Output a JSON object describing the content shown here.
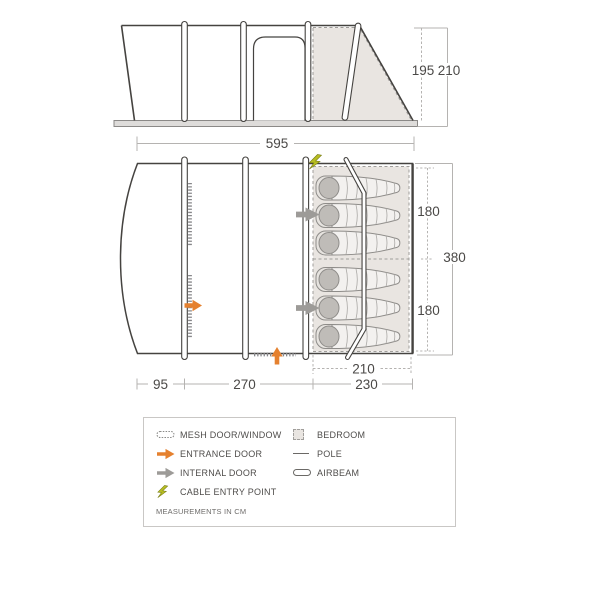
{
  "elevation": {
    "height_inner_cm": "195",
    "height_peak_cm": "210",
    "width_cm": "595"
  },
  "plan": {
    "bedroom_depth_upper_cm": "180",
    "bedroom_depth_lower_cm": "180",
    "depth_total_cm": "380",
    "bedroom_inner_width_cm": "210",
    "porch_width_cm": "95",
    "living_width_cm": "270",
    "bedroom_section_width_cm": "230"
  },
  "legend": {
    "items_left": [
      {
        "icon": "mesh-door-window-icon",
        "label": "MESH DOOR/WINDOW"
      },
      {
        "icon": "entrance-door-icon",
        "label": "ENTRANCE DOOR"
      },
      {
        "icon": "internal-door-icon",
        "label": "INTERNAL DOOR"
      },
      {
        "icon": "cable-entry-point-icon",
        "label": "CABLE ENTRY POINT"
      }
    ],
    "items_right": [
      {
        "icon": "bedroom-icon",
        "label": "BEDROOM"
      },
      {
        "icon": "pole-icon",
        "label": "POLE"
      },
      {
        "icon": "airbeam-icon",
        "label": "AIRBEAM"
      }
    ],
    "note": "MEASUREMENTS IN CM"
  },
  "colors": {
    "entrance_orange": "#e5812f",
    "internal_gray": "#9d9b98",
    "bedroom_fill": "#e9e5e1",
    "cable_green": "#b7bd22",
    "outline": "#454340",
    "dimension_gray": "#b5b3b1"
  }
}
